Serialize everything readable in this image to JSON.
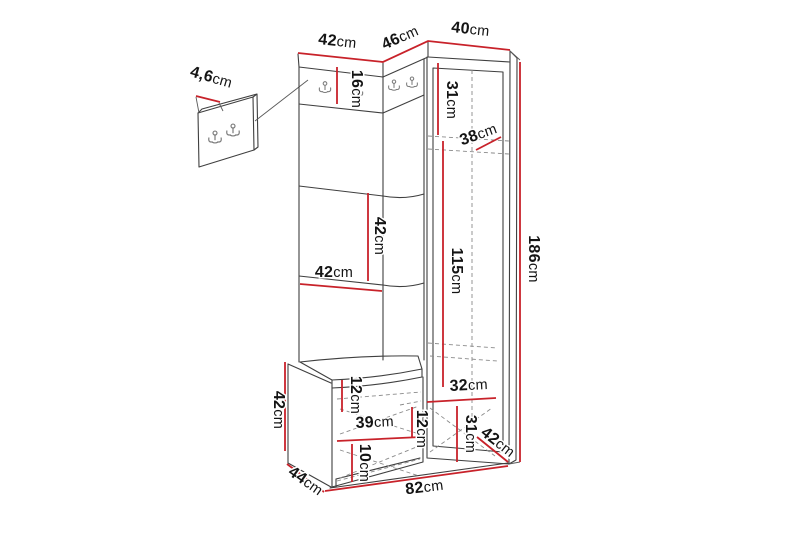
{
  "page": {
    "background": "#ffffff"
  },
  "diagram": {
    "type": "furniture-dimension-diagram",
    "subject": "hallway corner wardrobe with coat-hook panels, bench and separate wall hook panel",
    "unit_suffix": "cm",
    "colors": {
      "dimension_line": "#c8222a",
      "outline": "#3f3f3f",
      "hidden_line": "#8a8a8a",
      "label_text": "#141414",
      "background": "#ffffff"
    },
    "measurements": {
      "top_section_widths_cm": [
        42,
        46,
        40
      ],
      "hook_strip_height_cm": 16,
      "wall_panel_thickness_cm": 4.6,
      "cabinet_upper_section_height_cm": 31,
      "cabinet_interior_width_cm": 38,
      "cabinet_door_height_cm": 115,
      "total_height_cm": 186,
      "back_panel_square_height_cm": 42,
      "back_panel_square_width_cm": 42,
      "bench_height_cm": 42,
      "bench_depth_cm": 44,
      "bench_cushion_section_cm": 12,
      "bench_shelf_width_cm": 39,
      "bench_right_shelf_spacing_cm": 12,
      "bench_bottom_shelf_height_cm": 10,
      "cabinet_bottom_width_cm": 32,
      "cabinet_bottom_section_height_cm": 31,
      "cabinet_depth_cm": 42,
      "total_width_cm": 82
    },
    "labels": [
      {
        "id": "top-width-left",
        "num": "42",
        "unit": "cm",
        "x": 337,
        "y": 46,
        "rot": 6
      },
      {
        "id": "top-width-middle",
        "num": "46",
        "unit": "cm",
        "x": 402,
        "y": 42,
        "rot": -24
      },
      {
        "id": "top-width-right",
        "num": "40",
        "unit": "cm",
        "x": 470,
        "y": 34,
        "rot": 6
      },
      {
        "id": "panel-thickness",
        "num": "4,6",
        "unit": "cm",
        "x": 210,
        "y": 82,
        "rot": 16
      },
      {
        "id": "hook-strip-height",
        "num": "16",
        "unit": "cm",
        "x": 352,
        "y": 89,
        "rot": 90
      },
      {
        "id": "cabinet-top-section",
        "num": "31",
        "unit": "cm",
        "x": 447,
        "y": 100,
        "rot": 90
      },
      {
        "id": "cabinet-inner-width",
        "num": "38",
        "unit": "cm",
        "x": 480,
        "y": 139,
        "rot": -20
      },
      {
        "id": "panel-square-height",
        "num": "42",
        "unit": "cm",
        "x": 375,
        "y": 236,
        "rot": 90
      },
      {
        "id": "panel-square-width",
        "num": "42",
        "unit": "cm",
        "x": 334,
        "y": 277,
        "rot": 0
      },
      {
        "id": "door-height",
        "num": "115",
        "unit": "cm",
        "x": 452,
        "y": 271,
        "rot": 90
      },
      {
        "id": "total-height",
        "num": "186",
        "unit": "cm",
        "x": 529,
        "y": 259,
        "rot": 90
      },
      {
        "id": "bench-height",
        "num": "42",
        "unit": "cm",
        "x": 274,
        "y": 410,
        "rot": 90
      },
      {
        "id": "cushion-section",
        "num": "12",
        "unit": "cm",
        "x": 351,
        "y": 395,
        "rot": 90
      },
      {
        "id": "bench-shelf-width",
        "num": "39",
        "unit": "cm",
        "x": 375,
        "y": 427,
        "rot": -3
      },
      {
        "id": "bench-right-spacing",
        "num": "12",
        "unit": "cm",
        "x": 417,
        "y": 429,
        "rot": 90
      },
      {
        "id": "bench-bottom-shelf",
        "num": "10",
        "unit": "cm",
        "x": 360,
        "y": 463,
        "rot": 90
      },
      {
        "id": "cabinet-bottom-width",
        "num": "32",
        "unit": "cm",
        "x": 469,
        "y": 390,
        "rot": -3
      },
      {
        "id": "cabinet-bottom-sect",
        "num": "31",
        "unit": "cm",
        "x": 466,
        "y": 434,
        "rot": 90
      },
      {
        "id": "cabinet-depth",
        "num": "42",
        "unit": "cm",
        "x": 495,
        "y": 446,
        "rot": 38
      },
      {
        "id": "bench-depth",
        "num": "44",
        "unit": "cm",
        "x": 303,
        "y": 485,
        "rot": 35
      },
      {
        "id": "total-width",
        "num": "82",
        "unit": "cm",
        "x": 425,
        "y": 492,
        "rot": -7
      }
    ]
  }
}
